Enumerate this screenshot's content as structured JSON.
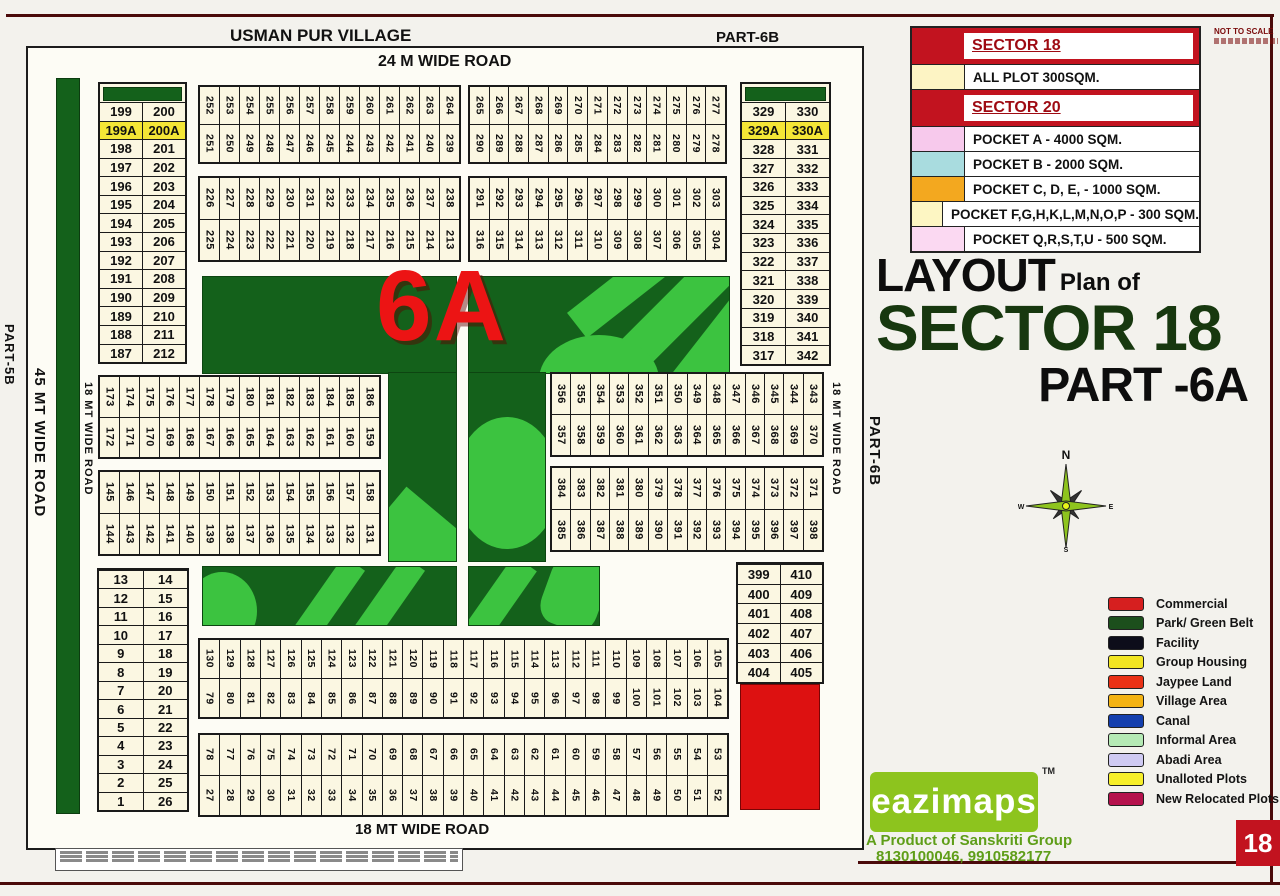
{
  "labels": {
    "village": "USMAN PUR VILLAGE",
    "part_6b_top": "PART-6B",
    "part_5b": "PART-5B",
    "part_6d": "PART-6D",
    "part_6b_right": "PART-6B",
    "road_24m": "24 M WIDE ROAD",
    "road_45mt": "45 MT WIDE ROAD",
    "road_18mt_left": "18 MT WIDE ROAD",
    "road_18mt_right": "18 MT WIDE ROAD",
    "road_18mt_bottom": "18 MT WIDE ROAD",
    "park_label": "6A",
    "not_to_scale": "NOT TO SCALE",
    "page_number": "18"
  },
  "title_block": {
    "word1": "LAYOUT",
    "word2": "Plan of",
    "line2": "SECTOR 18",
    "line3": "PART -6A"
  },
  "compass": {
    "n": "N",
    "e": "E",
    "s": "S",
    "w": "W"
  },
  "legend_table": {
    "sections": [
      {
        "title": "SECTOR 18",
        "rows": [
          {
            "swatch": "#fdf4c4",
            "label": "ALL PLOT  300SQM."
          }
        ]
      },
      {
        "title": "SECTOR 20",
        "rows": [
          {
            "swatch": "#f7c9ec",
            "label": "POCKET A   -  4000 SQM."
          },
          {
            "swatch": "#a9dcdf",
            "label": "POCKET B   -  2000 SQM."
          },
          {
            "swatch": "#f3a81f",
            "label": "POCKET C, D, E, - 1000 SQM."
          },
          {
            "swatch": "#fdf6c3",
            "label": "POCKET  F,G,H,K,L,M,N,O,P  -  300 SQM."
          },
          {
            "swatch": "#fbd9f2",
            "label": "POCKET Q,R,S,T,U   -  500 SQM."
          }
        ]
      }
    ]
  },
  "legend_items": [
    {
      "color": "#d61f1f",
      "label": "Commercial"
    },
    {
      "color": "#1c4f1c",
      "label": "Park/ Green Belt"
    },
    {
      "color": "#0d0d1a",
      "label": "Facility"
    },
    {
      "color": "#f2e522",
      "label": "Group Housing"
    },
    {
      "color": "#ea3115",
      "label": "Jaypee Land"
    },
    {
      "color": "#f4b313",
      "label": "Village Area"
    },
    {
      "color": "#143fae",
      "label": "Canal"
    },
    {
      "color": "#b5eab5",
      "label": "Informal Area"
    },
    {
      "color": "#cfcaf2",
      "label": "Abadi Area"
    },
    {
      "color": "#f7ef2a",
      "label": "Unalloted Plots"
    },
    {
      "color": "#b5124d",
      "label": "New Relocated Plots"
    }
  ],
  "branding": {
    "logo_text": "eazimaps",
    "trademark": "TM",
    "tagline": "A Product of Sanskriti Group",
    "phone": "8130100046, 9910582177"
  },
  "blocks": {
    "left_pairs": {
      "rows": [
        [
          "199",
          "200"
        ],
        [
          "199A",
          "200A"
        ],
        [
          "198",
          "201"
        ],
        [
          "197",
          "202"
        ],
        [
          "196",
          "203"
        ],
        [
          "195",
          "204"
        ],
        [
          "194",
          "205"
        ],
        [
          "193",
          "206"
        ],
        [
          "192",
          "207"
        ],
        [
          "191",
          "208"
        ],
        [
          "190",
          "209"
        ],
        [
          "189",
          "210"
        ],
        [
          "188",
          "211"
        ],
        [
          "187",
          "212"
        ]
      ]
    },
    "right_pairs": {
      "rows": [
        [
          "329",
          "330"
        ],
        [
          "329A",
          "330A"
        ],
        [
          "328",
          "331"
        ],
        [
          "327",
          "332"
        ],
        [
          "326",
          "333"
        ],
        [
          "325",
          "334"
        ],
        [
          "324",
          "335"
        ],
        [
          "323",
          "336"
        ],
        [
          "322",
          "337"
        ],
        [
          "321",
          "338"
        ],
        [
          "320",
          "339"
        ],
        [
          "319",
          "340"
        ],
        [
          "318",
          "341"
        ],
        [
          "317",
          "342"
        ]
      ]
    },
    "bottom_left_pairs": {
      "rows": [
        [
          "13",
          "14"
        ],
        [
          "12",
          "15"
        ],
        [
          "11",
          "16"
        ],
        [
          "10",
          "17"
        ],
        [
          "9",
          "18"
        ],
        [
          "8",
          "19"
        ],
        [
          "7",
          "20"
        ],
        [
          "6",
          "21"
        ],
        [
          "5",
          "22"
        ],
        [
          "4",
          "23"
        ],
        [
          "3",
          "24"
        ],
        [
          "2",
          "25"
        ],
        [
          "1",
          "26"
        ]
      ]
    },
    "bottom_right_pairs": {
      "rows": [
        [
          "399",
          "410"
        ],
        [
          "400",
          "409"
        ],
        [
          "401",
          "408"
        ],
        [
          "402",
          "407"
        ],
        [
          "403",
          "406"
        ],
        [
          "404",
          "405"
        ]
      ]
    },
    "strips": {
      "top1_left": {
        "upper": [
          252,
          253,
          254,
          255,
          256,
          257,
          258,
          259,
          260,
          261,
          262,
          263,
          264
        ],
        "lower": [
          251,
          250,
          249,
          248,
          247,
          246,
          245,
          244,
          243,
          242,
          241,
          240,
          239
        ]
      },
      "top1_right": {
        "upper": [
          265,
          266,
          267,
          268,
          269,
          270,
          271,
          272,
          273,
          274,
          275,
          276,
          277
        ],
        "lower": [
          290,
          289,
          288,
          287,
          286,
          285,
          284,
          283,
          282,
          281,
          280,
          279,
          278
        ]
      },
      "top2_left": {
        "upper": [
          226,
          227,
          228,
          229,
          230,
          231,
          232,
          233,
          234,
          235,
          236,
          237,
          238
        ],
        "lower": [
          225,
          224,
          223,
          222,
          221,
          220,
          219,
          218,
          217,
          216,
          215,
          214,
          213
        ]
      },
      "top2_right": {
        "upper": [
          291,
          292,
          293,
          294,
          295,
          296,
          297,
          298,
          299,
          300,
          301,
          302,
          303
        ],
        "lower": [
          316,
          315,
          314,
          313,
          312,
          311,
          310,
          309,
          308,
          307,
          306,
          305,
          304
        ]
      },
      "mid_left_1": {
        "upper": [
          173,
          174,
          175,
          176,
          177,
          178,
          179,
          180,
          181,
          182,
          183,
          184,
          185,
          186
        ],
        "lower": [
          172,
          171,
          170,
          169,
          168,
          167,
          166,
          165,
          164,
          163,
          162,
          161,
          160,
          159
        ]
      },
      "mid_left_2": {
        "upper": [
          145,
          146,
          147,
          148,
          149,
          150,
          151,
          152,
          153,
          154,
          155,
          156,
          157,
          158
        ],
        "lower": [
          144,
          143,
          142,
          141,
          140,
          139,
          138,
          137,
          136,
          135,
          134,
          133,
          132,
          131
        ]
      },
      "mid_right_1": {
        "upper": [
          356,
          355,
          354,
          353,
          352,
          351,
          350,
          349,
          348,
          347,
          346,
          345,
          344,
          343
        ],
        "lower": [
          357,
          358,
          359,
          360,
          361,
          362,
          363,
          364,
          365,
          366,
          367,
          368,
          369,
          370
        ]
      },
      "mid_right_2": {
        "upper": [
          384,
          383,
          382,
          381,
          380,
          379,
          378,
          377,
          376,
          375,
          374,
          373,
          372,
          371
        ],
        "lower": [
          385,
          386,
          387,
          388,
          389,
          390,
          391,
          392,
          393,
          394,
          395,
          396,
          397,
          398
        ]
      },
      "bottom_1": {
        "upper": [
          130,
          129,
          128,
          127,
          126,
          125,
          124,
          123,
          122,
          121,
          120,
          119,
          118,
          117,
          116,
          115,
          114,
          113,
          112,
          111,
          110,
          109,
          108,
          107,
          106,
          105
        ],
        "lower": [
          79,
          80,
          81,
          82,
          83,
          84,
          85,
          86,
          87,
          88,
          89,
          90,
          91,
          92,
          93,
          94,
          95,
          96,
          97,
          98,
          99,
          100,
          101,
          102,
          103,
          104
        ]
      },
      "bottom_2": {
        "upper": [
          78,
          77,
          76,
          75,
          74,
          73,
          72,
          71,
          70,
          69,
          68,
          67,
          66,
          65,
          64,
          63,
          62,
          61,
          60,
          59,
          58,
          57,
          56,
          55,
          54,
          53
        ],
        "lower": [
          27,
          28,
          29,
          30,
          31,
          32,
          33,
          34,
          35,
          36,
          37,
          38,
          39,
          40,
          41,
          42,
          43,
          44,
          45,
          46,
          47,
          48,
          49,
          50,
          51,
          52
        ]
      }
    }
  }
}
